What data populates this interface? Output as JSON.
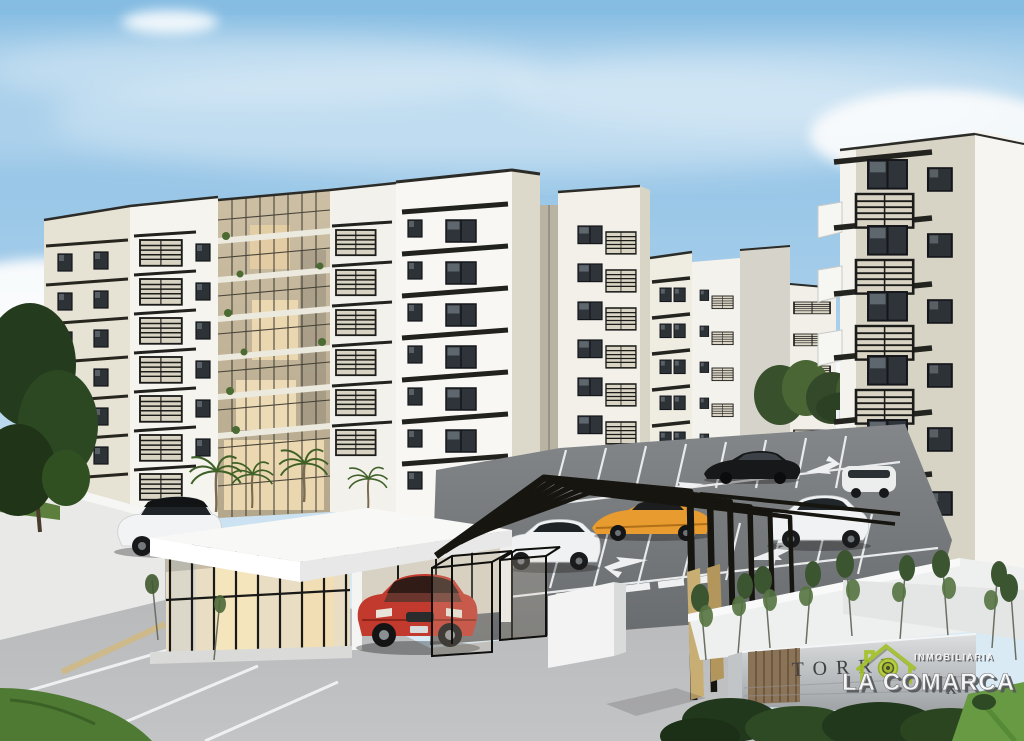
{
  "scene": {
    "type": "3D architectural rendering",
    "subject": "Gated residential apartment complex with cream mid-rise towers, louvered balconies, glass atrium, black entrance portal with gold columns, white gatehouse, parking lot with cars and landscaping"
  },
  "entrance_sign": {
    "visible_text_start": "TORRE",
    "visible_text_end": "X"
  },
  "watermark": {
    "brand": "LA COMARCA",
    "tagline": "INMOBILIARIA",
    "icon": "house-logo-icon"
  },
  "vehicles": [
    {
      "name": "white suv parked left",
      "color": "#f2f3f4"
    },
    {
      "name": "red suv at gatehouse",
      "color": "#c23a2d"
    },
    {
      "name": "white suv in lot (left)",
      "color": "#eff1f2"
    },
    {
      "name": "orange sports car",
      "color": "#e89b2e"
    },
    {
      "name": "black sedan",
      "color": "#17181a"
    },
    {
      "name": "white suv in lot (right)",
      "color": "#f0f2f3"
    },
    {
      "name": "white minivan background",
      "color": "#eceeee"
    }
  ],
  "colors": {
    "sky": "#8ec1e4",
    "cloud": "#fdfdfd",
    "facade_white": "#f3f2ee",
    "facade_beige": "#d7d3c5",
    "ledge_dark": "#21211d",
    "atrium_warm": "#e9d9b8",
    "gold_accent": "#c7ab70",
    "asphalt_dark": "#75787b",
    "asphalt_light": "#b5b6b8",
    "grass": "#5e8a3c",
    "logo_green": "#a3c22a",
    "sign_wall": "#c2c5c7",
    "wood_panel": "#8b7358"
  }
}
